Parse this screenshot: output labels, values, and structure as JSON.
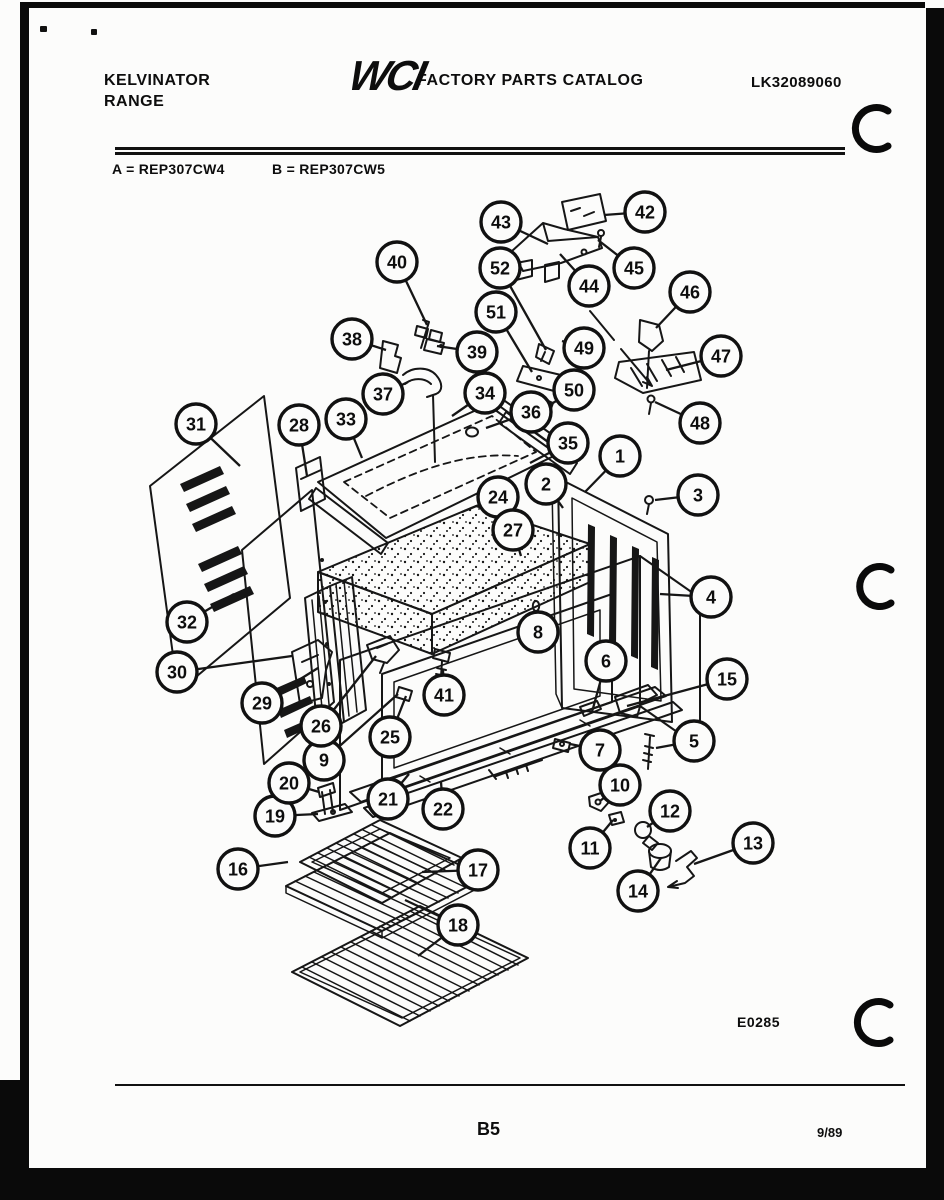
{
  "page": {
    "header": {
      "brand_line1": "KELVINATOR",
      "brand_line2": "RANGE",
      "logo": "WCI",
      "catalog_title": "FACTORY PARTS CATALOG",
      "catalog_number": "LK32089060"
    },
    "models": {
      "model_a": "A = REP307CW4",
      "model_b": "B = REP307CW5"
    },
    "footer": {
      "drawing_number": "E0285",
      "page_number": "B5",
      "revision_date": "9/89"
    }
  },
  "diagram": {
    "description": "Exploded parts view of range body, cabinet and oven racks",
    "callouts": [
      {
        "n": "1",
        "x": 620,
        "y": 456,
        "tx": 585,
        "ty": 492
      },
      {
        "n": "2",
        "x": 546,
        "y": 484,
        "tx": 563,
        "ty": 508
      },
      {
        "n": "3",
        "x": 698,
        "y": 495,
        "tx": 655,
        "ty": 500
      },
      {
        "n": "4",
        "x": 711,
        "y": 597,
        "tx": 660,
        "ty": 594
      },
      {
        "n": "5",
        "x": 694,
        "y": 741,
        "tx": 656,
        "ty": 748
      },
      {
        "n": "6",
        "x": 606,
        "y": 661,
        "tx": 592,
        "ty": 712
      },
      {
        "n": "7",
        "x": 600,
        "y": 750,
        "tx": 570,
        "ty": 744
      },
      {
        "n": "8",
        "x": 538,
        "y": 632,
        "tx": 536,
        "ty": 610
      },
      {
        "n": "9",
        "x": 324,
        "y": 760,
        "tx": 398,
        "ty": 694
      },
      {
        "n": "10",
        "x": 620,
        "y": 785,
        "tx": 600,
        "ty": 801
      },
      {
        "n": "11",
        "x": 590,
        "y": 848,
        "tx": 613,
        "ty": 820
      },
      {
        "n": "12",
        "x": 670,
        "y": 811,
        "tx": 647,
        "ty": 827
      },
      {
        "n": "13",
        "x": 753,
        "y": 843,
        "tx": 694,
        "ty": 864
      },
      {
        "n": "14",
        "x": 638,
        "y": 891,
        "tx": 661,
        "ty": 858
      },
      {
        "n": "15",
        "x": 727,
        "y": 679,
        "tx": 627,
        "ty": 706
      },
      {
        "n": "16",
        "x": 238,
        "y": 869,
        "tx": 288,
        "ty": 862
      },
      {
        "n": "17",
        "x": 478,
        "y": 870,
        "tx": 422,
        "ty": 872
      },
      {
        "n": "18",
        "x": 458,
        "y": 925,
        "tx": 405,
        "ty": 900,
        "tx2": 418,
        "ty2": 956
      },
      {
        "n": "19",
        "x": 275,
        "y": 816,
        "tx": 318,
        "ty": 814
      },
      {
        "n": "20",
        "x": 289,
        "y": 783,
        "tx": 319,
        "ty": 792
      },
      {
        "n": "21",
        "x": 388,
        "y": 799,
        "tx": 409,
        "ty": 774
      },
      {
        "n": "22",
        "x": 443,
        "y": 809,
        "tx": 441,
        "ty": 782
      },
      {
        "n": "24",
        "x": 498,
        "y": 497,
        "tx": 462,
        "ty": 512
      },
      {
        "n": "25",
        "x": 390,
        "y": 737,
        "tx": 406,
        "ty": 696
      },
      {
        "n": "26",
        "x": 321,
        "y": 726,
        "tx": 376,
        "ty": 656
      },
      {
        "n": "27",
        "x": 513,
        "y": 530,
        "tx": 521,
        "ty": 556
      },
      {
        "n": "28",
        "x": 299,
        "y": 425,
        "tx": 307,
        "ty": 476
      },
      {
        "n": "29",
        "x": 262,
        "y": 703,
        "tx": 318,
        "ty": 668
      },
      {
        "n": "30",
        "x": 177,
        "y": 672,
        "tx": 292,
        "ty": 656
      },
      {
        "n": "31",
        "x": 196,
        "y": 424,
        "tx": 240,
        "ty": 466
      },
      {
        "n": "32",
        "x": 187,
        "y": 622,
        "tx": 234,
        "ty": 594
      },
      {
        "n": "33",
        "x": 346,
        "y": 419,
        "tx": 362,
        "ty": 458
      },
      {
        "n": "34",
        "x": 485,
        "y": 393,
        "tx": 452,
        "ty": 416
      },
      {
        "n": "35",
        "x": 568,
        "y": 443,
        "tx": 530,
        "ty": 463
      },
      {
        "n": "36",
        "x": 531,
        "y": 412,
        "tx": 486,
        "ty": 428
      },
      {
        "n": "37",
        "x": 383,
        "y": 394,
        "tx": 408,
        "ty": 382
      },
      {
        "n": "38",
        "x": 352,
        "y": 339,
        "tx": 386,
        "ty": 350
      },
      {
        "n": "39",
        "x": 477,
        "y": 352,
        "tx": 437,
        "ty": 346
      },
      {
        "n": "40",
        "x": 397,
        "y": 262,
        "tx": 427,
        "ty": 325
      },
      {
        "n": "41",
        "x": 444,
        "y": 695,
        "tx": 443,
        "ty": 670
      },
      {
        "n": "42",
        "x": 645,
        "y": 212,
        "tx": 604,
        "ty": 215
      },
      {
        "n": "43",
        "x": 501,
        "y": 222,
        "tx": 548,
        "ty": 244
      },
      {
        "n": "44",
        "x": 589,
        "y": 286,
        "tx": 560,
        "ty": 254
      },
      {
        "n": "45",
        "x": 634,
        "y": 268,
        "tx": 598,
        "ty": 240
      },
      {
        "n": "46",
        "x": 690,
        "y": 292,
        "tx": 656,
        "ty": 328
      },
      {
        "n": "47",
        "x": 721,
        "y": 356,
        "tx": 666,
        "ty": 370
      },
      {
        "n": "48",
        "x": 700,
        "y": 423,
        "tx": 655,
        "ty": 402
      },
      {
        "n": "49",
        "x": 584,
        "y": 348,
        "tx": 562,
        "ty": 341
      },
      {
        "n": "50",
        "x": 574,
        "y": 390,
        "tx": 548,
        "ty": 406
      },
      {
        "n": "51",
        "x": 496,
        "y": 312,
        "tx": 532,
        "ty": 372
      },
      {
        "n": "52",
        "x": 500,
        "y": 268,
        "tx": 546,
        "ty": 350
      }
    ]
  }
}
